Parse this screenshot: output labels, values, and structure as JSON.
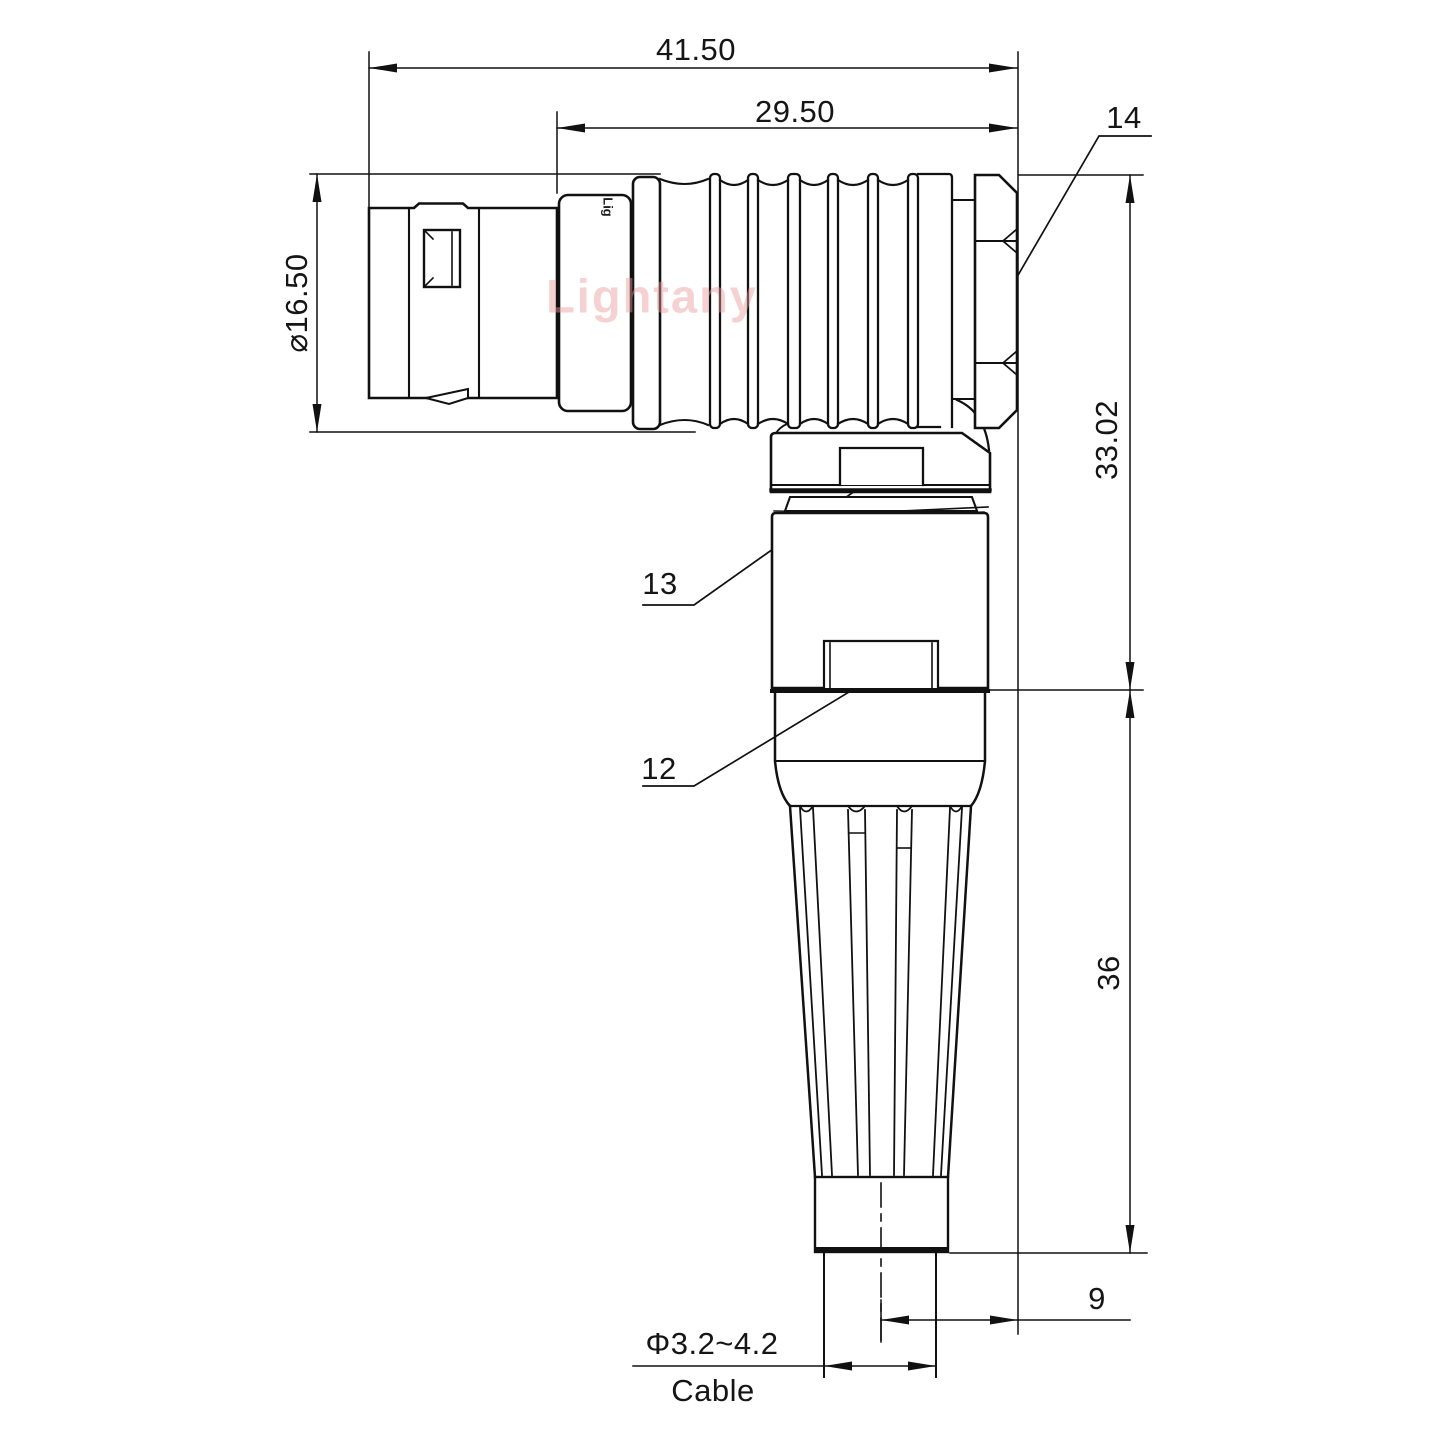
{
  "watermark": "Lightany",
  "part_marking": "Lig",
  "dimensions": {
    "overall_length": "41.50",
    "rear_length": "29.50",
    "shell_diameter": "⌀16.50",
    "height_to_axis": "33.02",
    "boot_height": "36",
    "cable_offset": "9",
    "cable_diameter": "Φ3.2~4.2",
    "cable_label": "Cable"
  },
  "callouts": {
    "nut": "14",
    "coupling_nut": "13",
    "housing": "12"
  }
}
